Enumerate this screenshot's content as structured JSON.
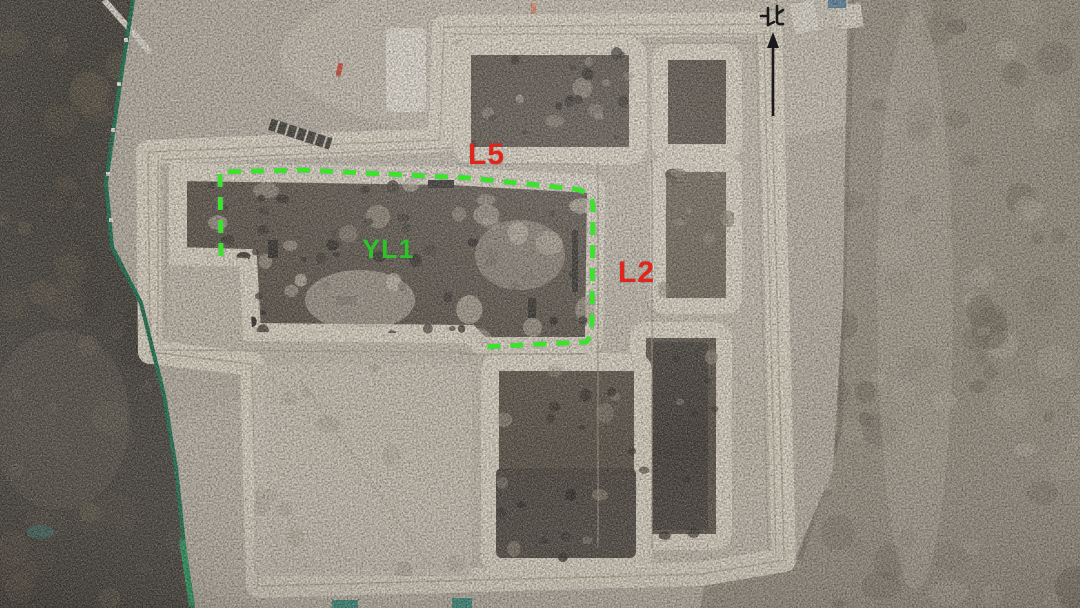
{
  "image": {
    "description": "Aerial drone photograph of an archaeological excavation site: a large rectangular trench compound with earthen balks, surrounded by scrubland, with annotated roads L5 and L2, building-foundation area YL1 outlined by a green dashed line, a green construction fence on the west side, and a north arrow at top right",
    "width_px": 1080,
    "height_px": 608
  },
  "annotations": {
    "north_label": "北",
    "labels": {
      "l5": {
        "text": "L5",
        "color": "#e0251c"
      },
      "l2": {
        "text": "L2",
        "color": "#e0251c"
      },
      "yl1": {
        "text": "YL1",
        "color": "#2fc32a"
      }
    }
  },
  "colors": {
    "ground": "#b5ada0",
    "wall": "#d8d0c0",
    "compound": "#bfb7a9",
    "pit": "#5b5349",
    "scrub": "#47423b",
    "terrain_right": "#968d7f",
    "label_red": "#e0251c",
    "label_green": "#2fc32a",
    "dash_green": "#3ce32b",
    "fence_green": "#1e6f4f",
    "ink": "#1a1a1a"
  }
}
